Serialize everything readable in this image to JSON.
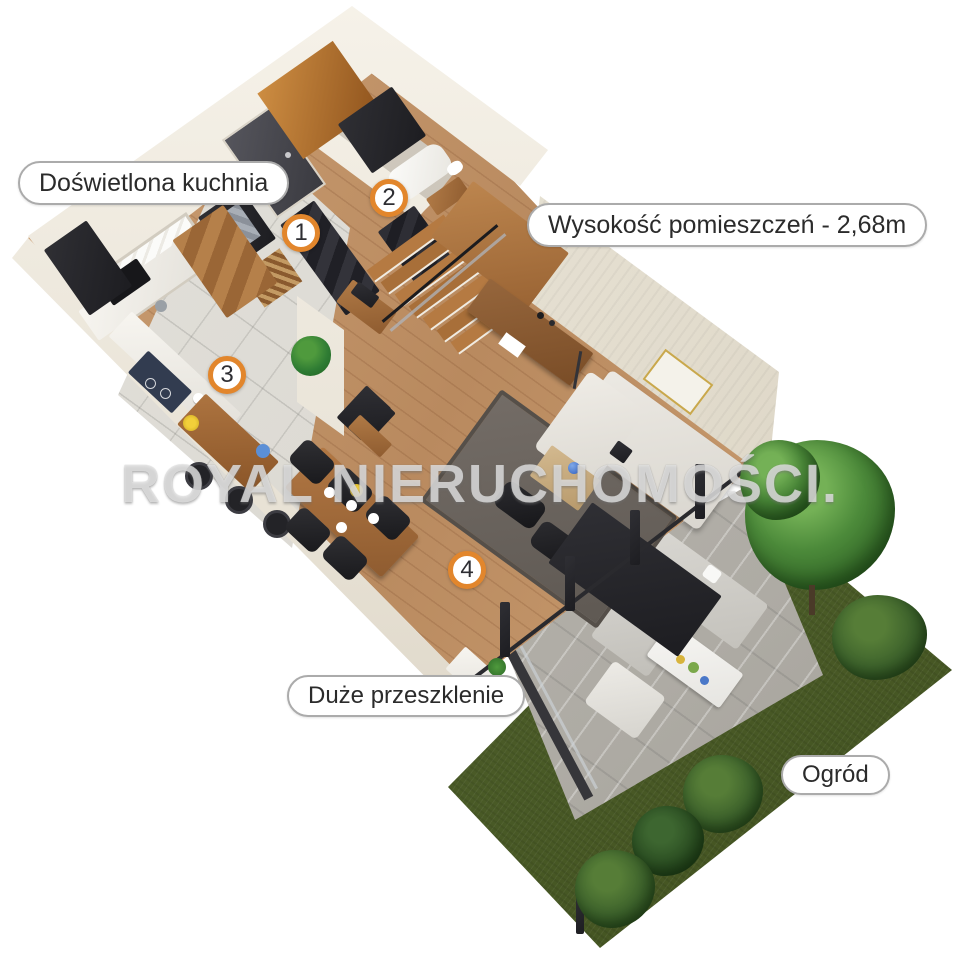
{
  "annotations": {
    "kitchen_label": "Doświetlona kuchnia",
    "height_label": "Wysokość pomieszczeń - 2,68m",
    "glazing_label": "Duże przeszklenie",
    "garden_label": "Ogród"
  },
  "markers": {
    "m1": "1",
    "m2": "2",
    "m3": "3",
    "m4": "4"
  },
  "watermark": "ROYAL NIERUCHOMOŚCI.",
  "colors": {
    "marker_ring_orange": "#e2862c",
    "pill_border_gray": "#ababab",
    "label_text": "#2b2b2b",
    "wall_cream": "#efe9dd",
    "wood_floor": "#bf9571",
    "kitchen_tile": "#dcdad4",
    "dark_furniture": "#26262b",
    "wood_furniture": "#a8713f",
    "sofa_light": "#e6e3dd",
    "rug_gray": "#6e6761",
    "terrace_concrete": "#b9b6b0",
    "grass_green": "#57692e",
    "tree_green": "#3f7a33",
    "watermark_white": "rgba(242,242,242,0.68)"
  }
}
